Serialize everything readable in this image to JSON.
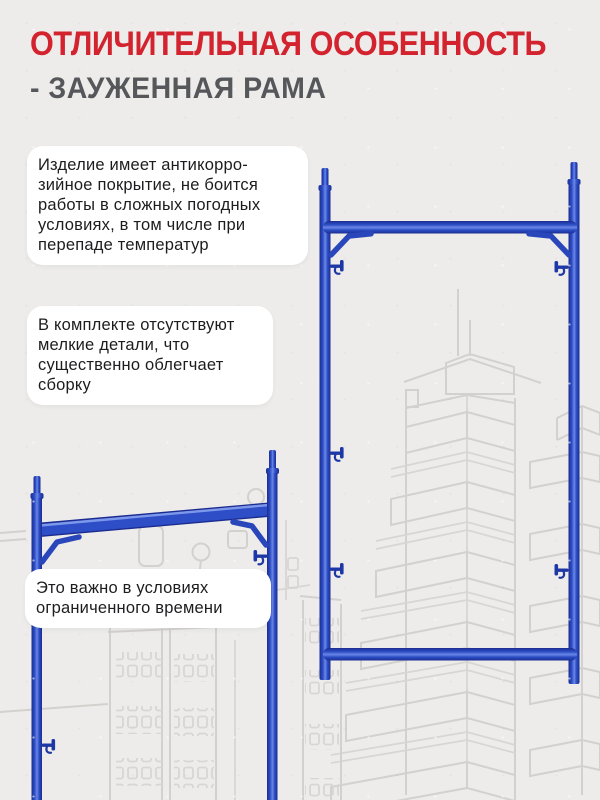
{
  "header": {
    "title": "ОТЛИЧИТЕЛЬНАЯ ОСОБЕННОСТЬ",
    "subtitle": "- ЗАУЖЕННАЯ РАМА"
  },
  "callouts": [
    {
      "text": "Изделие имеет антикорро-\nзийное покрытие, не боится\nработы в сложных погодных\nусловиях, в том числе при\nперепаде температур"
    },
    {
      "text": "В комплекте отсутствуют\nмелкие детали, что\nсущественно облегчает\nсборку"
    },
    {
      "text": "Это важно в условиях\nограниченного времени"
    }
  ],
  "illustration": {
    "main_object": "blue scaffold frame, front view",
    "secondary_object": "blue scaffold frame, tilted view",
    "background": "light gray sketch of tower buildings"
  },
  "theme": {
    "page_bg": "#edecea",
    "card_bg": "#ffffff",
    "accent_red": "#d2232e",
    "heading_gray": "#55575b",
    "text_dark": "#1d1d1f",
    "frame_blue": "#2d4ec6",
    "frame_blue_dark": "#1b2c90",
    "frame_blue_light": "#6b87e6",
    "sketch_gray": "#d2d1ce"
  }
}
